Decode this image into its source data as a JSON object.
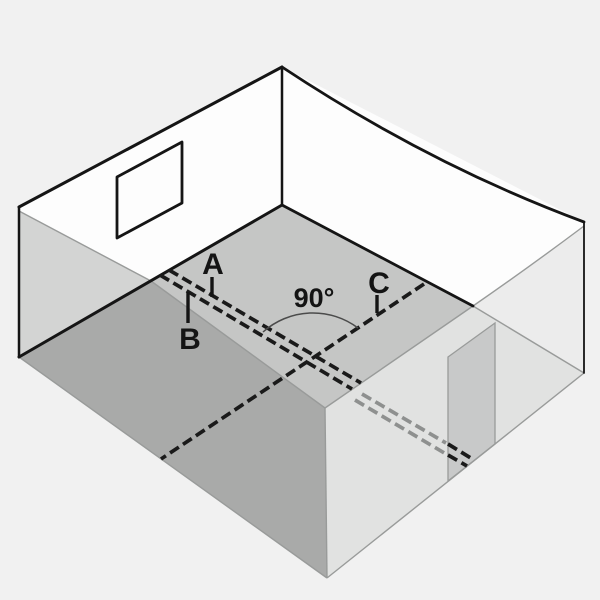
{
  "figure": {
    "labels": {
      "line_a": "A",
      "line_b": "B",
      "line_c": "C",
      "angle": "90°"
    },
    "colors": {
      "background": "#f1f1f1",
      "wall": "#fdfdfd",
      "floor": "#c5c6c5",
      "near_left_wall": "#a9aaa9",
      "left_wall_tint": "#d3d4d3",
      "near_right_wall": "#e1e2e1",
      "near_right_wall_upper": "#ececec",
      "doorway": "#c8c9c9",
      "edge_black": "#151515",
      "edge_gray": "#999b9a",
      "dash_black": "#1a1a1a",
      "dash_gray": "#8e908f",
      "arc": "#4b4b4b",
      "label": "#141414"
    }
  }
}
